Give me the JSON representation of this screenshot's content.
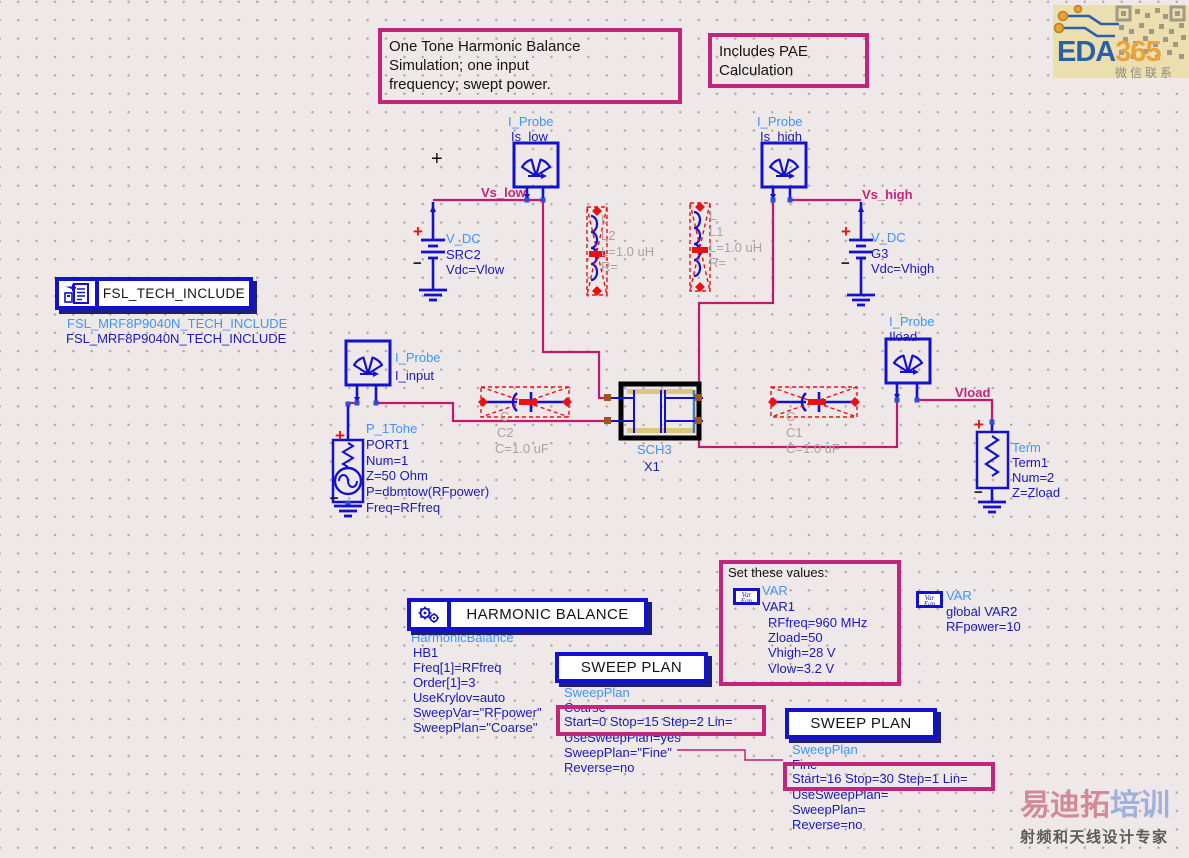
{
  "glyphs": {
    "plus": "+",
    "minus": "−"
  },
  "colors": {
    "background": "#EFE8E8",
    "wire": "#C2186E",
    "annotation": "#C0267C",
    "component_blue": "#1212CE",
    "type_label_blue": "#3E96F5",
    "param_text_navy": "#1A1AB8",
    "disabled_gray": "#ABA1A1",
    "selection_red": "#E81212"
  },
  "notes": {
    "note1": {
      "lines": [
        "One Tone Harmonic Balance",
        "Simulation; one input",
        "frequency; swept power."
      ]
    },
    "note2": {
      "lines": [
        "Includes PAE",
        "Calculation"
      ]
    }
  },
  "tech_include": {
    "title": "FSL_TECH_INCLUDE",
    "line1": "FSL_MRF8P9040N_TECH_INCLUDE",
    "line2": "FSL_MRF8P9040N_TECH_INCLUDE"
  },
  "probes": {
    "is_low": {
      "type": "I_Probe",
      "name": "Is_low"
    },
    "is_high": {
      "type": "I_Probe",
      "name": "Is_high"
    },
    "i_input": {
      "type": "I_Probe",
      "name": "I_input"
    },
    "iload": {
      "type": "I_Probe",
      "name": "Iload"
    }
  },
  "nets": {
    "vs_low": "Vs_low",
    "vs_high": "Vs_high",
    "vload": "Vload"
  },
  "sources": {
    "src2": {
      "type": "V_DC",
      "name": "SRC2",
      "param": "Vdc=Vlow"
    },
    "g3": {
      "type": "V_DC",
      "name": "G3",
      "param": "Vdc=Vhigh"
    }
  },
  "port1": {
    "type": "P_1Tone",
    "lines": [
      "PORT1",
      "Num=1",
      "Z=50 Ohm",
      "P=dbmtow(RFpower)",
      "Freq=RFfreq"
    ]
  },
  "term1": {
    "type": "Term",
    "lines": [
      "Term1",
      "Num=2",
      "Z=Zload"
    ]
  },
  "passives": {
    "l2": {
      "lines": [
        "L",
        "L2",
        "L=1.0 uH",
        "R="
      ]
    },
    "l1": {
      "lines": [
        "L",
        "L1",
        "L=1.0 uH",
        "R="
      ]
    },
    "c2": {
      "lines": [
        "C",
        "C2",
        "C=1.0 uF"
      ]
    },
    "c1": {
      "lines": [
        "C",
        "C1",
        "C=1.0 uF"
      ]
    }
  },
  "subckt": {
    "type": "SCH3",
    "name": "X1"
  },
  "hb": {
    "title": "HARMONIC BALANCE",
    "type": "HarmonicBalance",
    "lines": [
      "HB1",
      "Freq[1]=RFfreq",
      "Order[1]=3",
      "UseKrylov=auto",
      "SweepVar=\"RFpower\"",
      "SweepPlan=\"Coarse\""
    ]
  },
  "sweep1": {
    "title": "SWEEP PLAN",
    "type": "SweepPlan",
    "name": "Coarse",
    "highlight": "Start=0 Stop=15 Step=2 Lin=",
    "lines": [
      "UseSweepPlan=yes",
      "SweepPlan=\"Fine\"",
      "Reverse=no"
    ]
  },
  "sweep2": {
    "title": "SWEEP PLAN",
    "type": "SweepPlan",
    "name": "Fine",
    "highlight": "Start=16 Stop=30 Step=1 Lin=",
    "lines": [
      "UseSweepPlan=",
      "SweepPlan=",
      "Reverse=no"
    ]
  },
  "var1": {
    "box_title": "Set these values:",
    "type": "VAR",
    "name": "VAR1",
    "icon": {
      "line1": "Var",
      "line2": "Eqn"
    },
    "lines": [
      "RFfreq=960 MHz",
      "Zload=50",
      "Vhigh=28 V",
      "Vlow=3.2 V"
    ]
  },
  "var2": {
    "type": "VAR",
    "name": "global VAR2",
    "icon": {
      "line1": "Var",
      "line2": "Eqn"
    },
    "lines": [
      "RFpower=10"
    ]
  },
  "logos": {
    "eda365": {
      "part1": "EDA",
      "part2": "365",
      "caption": "微信联系"
    },
    "watermark": {
      "part1": "易迪拓",
      "part2": "培训",
      "subtitle": "射频和天线设计专家"
    }
  }
}
